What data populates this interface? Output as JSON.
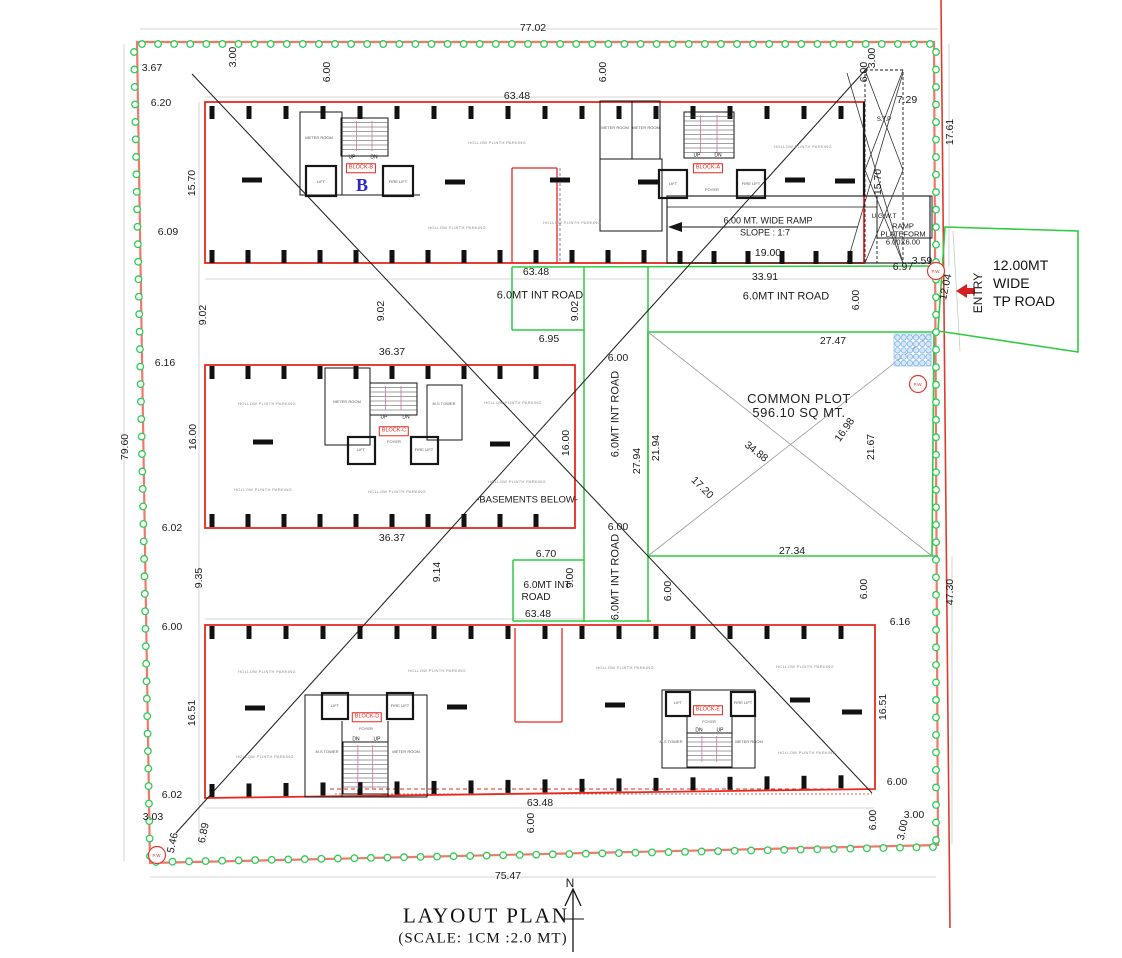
{
  "title": {
    "text": "LAYOUT PLAN",
    "scale": "(SCALE: 1CM :2.0 MT)"
  },
  "north": {
    "label": "N"
  },
  "tp_road": {
    "line1": "12.00MT",
    "line2": "WIDE",
    "line3": "TP ROAD",
    "entry": "ENTRY"
  },
  "common_plot": {
    "name": "COMMON PLOT",
    "area": "596.10 SQ MT."
  },
  "pw_marker": {
    "text": "P.W.",
    "positions": [
      [
        936,
        271
      ],
      [
        918,
        384
      ],
      [
        157,
        855
      ]
    ]
  },
  "parking": {
    "text": "HOLLOW PLINTH PARKING",
    "positions": [
      [
        497,
        143
      ],
      [
        457,
        228
      ],
      [
        572,
        223
      ],
      [
        803,
        147
      ],
      [
        267,
        404
      ],
      [
        513,
        403
      ],
      [
        263,
        490
      ],
      [
        397,
        492
      ],
      [
        517,
        482
      ],
      [
        267,
        672
      ],
      [
        437,
        671
      ],
      [
        625,
        668
      ],
      [
        805,
        667
      ],
      [
        265,
        757
      ],
      [
        807,
        753
      ]
    ]
  },
  "colors": {
    "building_red": "#e8281e",
    "boundary_red": "#f0796d",
    "road_green": "#2ecc40",
    "block_letter_blue": "#2d26c8",
    "marker_red": "#e03a2f"
  },
  "labels": [
    {
      "t": "77.02",
      "x": 533,
      "y": 28
    },
    {
      "t": "3.00",
      "x": 233,
      "y": 57,
      "r": -90
    },
    {
      "t": "3.67",
      "x": 152,
      "y": 68
    },
    {
      "t": "6.00",
      "x": 327,
      "y": 72,
      "r": -90
    },
    {
      "t": "6.00",
      "x": 603,
      "y": 72,
      "r": -90
    },
    {
      "t": "6.20",
      "x": 161,
      "y": 103
    },
    {
      "t": "63.48",
      "x": 517,
      "y": 96
    },
    {
      "t": "3.00",
      "x": 872,
      "y": 58,
      "r": -90
    },
    {
      "t": "6.00",
      "x": 864,
      "y": 72,
      "r": -90
    },
    {
      "t": "7.29",
      "x": 907,
      "y": 100
    },
    {
      "t": "17.61",
      "x": 950,
      "y": 132,
      "r": -90
    },
    {
      "t": "15.70",
      "x": 192,
      "y": 183,
      "r": -90
    },
    {
      "t": "15.70",
      "x": 878,
      "y": 182,
      "r": -90
    },
    {
      "t": "6.09",
      "x": 168,
      "y": 232
    },
    {
      "t": "63.48",
      "x": 536,
      "y": 272
    },
    {
      "t": "33.91",
      "x": 765,
      "y": 277
    },
    {
      "t": "19.00",
      "x": 768,
      "y": 253
    },
    {
      "t": "6.97",
      "x": 903,
      "y": 267
    },
    {
      "t": "3.59",
      "x": 922,
      "y": 261
    },
    {
      "t": "9.02",
      "x": 203,
      "y": 315,
      "r": -90
    },
    {
      "t": "9.02",
      "x": 381,
      "y": 311,
      "r": -90
    },
    {
      "t": "9.02",
      "x": 575,
      "y": 311,
      "r": -90
    },
    {
      "t": "6.95",
      "x": 549,
      "y": 339
    },
    {
      "t": "6.00",
      "x": 856,
      "y": 300,
      "r": -90
    },
    {
      "t": "27.47",
      "x": 833,
      "y": 341
    },
    {
      "t": "12.04",
      "x": 946,
      "y": 287,
      "r": -78
    },
    {
      "t": "79.60",
      "x": 125,
      "y": 447,
      "r": -90
    },
    {
      "t": "6.16",
      "x": 165,
      "y": 363
    },
    {
      "t": "36.37",
      "x": 392,
      "y": 352
    },
    {
      "t": "16.00",
      "x": 193,
      "y": 437,
      "r": -90
    },
    {
      "t": "6.00",
      "x": 618,
      "y": 358
    },
    {
      "t": "16.00",
      "x": 566,
      "y": 443,
      "r": -90
    },
    {
      "t": "27.94",
      "x": 637,
      "y": 461,
      "r": -90
    },
    {
      "t": "21.94",
      "x": 656,
      "y": 448,
      "r": -90
    },
    {
      "t": "17.20",
      "x": 702,
      "y": 488,
      "r": 45
    },
    {
      "t": "34.88",
      "x": 756,
      "y": 452,
      "r": 38
    },
    {
      "t": "16.98",
      "x": 845,
      "y": 430,
      "r": -55
    },
    {
      "t": "21.67",
      "x": 871,
      "y": 447,
      "r": -90
    },
    {
      "t": "6.02",
      "x": 172,
      "y": 528
    },
    {
      "t": "36.37",
      "x": 392,
      "y": 538
    },
    {
      "t": "6.00",
      "x": 618,
      "y": 527
    },
    {
      "t": "27.34",
      "x": 792,
      "y": 551
    },
    {
      "t": "9.35",
      "x": 199,
      "y": 578,
      "r": -90
    },
    {
      "t": "9.14",
      "x": 437,
      "y": 572,
      "r": -90
    },
    {
      "t": "6.70",
      "x": 546,
      "y": 554
    },
    {
      "t": "9.00",
      "x": 570,
      "y": 578,
      "r": -90
    },
    {
      "t": "63.48",
      "x": 538,
      "y": 614
    },
    {
      "t": "6.00",
      "x": 668,
      "y": 591,
      "r": -90
    },
    {
      "t": "47.30",
      "x": 950,
      "y": 592,
      "r": -90
    },
    {
      "t": "6.00",
      "x": 864,
      "y": 589,
      "r": -90
    },
    {
      "t": "6.16",
      "x": 900,
      "y": 622
    },
    {
      "t": "16.51",
      "x": 883,
      "y": 707,
      "r": -90
    },
    {
      "t": "16.51",
      "x": 192,
      "y": 713,
      "r": -90
    },
    {
      "t": "6.00",
      "x": 172,
      "y": 627
    },
    {
      "t": "6.00",
      "x": 897,
      "y": 782
    },
    {
      "t": "6.02",
      "x": 172,
      "y": 795
    },
    {
      "t": "3.03",
      "x": 153,
      "y": 817
    },
    {
      "t": "5.46",
      "x": 173,
      "y": 843,
      "r": -78
    },
    {
      "t": "6.89",
      "x": 204,
      "y": 833,
      "r": -78
    },
    {
      "t": "63.48",
      "x": 540,
      "y": 803
    },
    {
      "t": "6.00",
      "x": 531,
      "y": 823,
      "r": -90
    },
    {
      "t": "6.00",
      "x": 873,
      "y": 820,
      "r": -90
    },
    {
      "t": "3.00",
      "x": 914,
      "y": 815
    },
    {
      "t": "3.00",
      "x": 903,
      "y": 830,
      "r": -78
    },
    {
      "t": "75.47",
      "x": 508,
      "y": 876
    },
    {
      "t": "6.0MT INT ROAD",
      "x": 540,
      "y": 296,
      "s": 11,
      "n": "road-label"
    },
    {
      "t": "6.0MT INT ROAD",
      "x": 786,
      "y": 297,
      "s": 11,
      "n": "road-label"
    },
    {
      "t": "6.0MT INT ROAD",
      "x": 616,
      "y": 414,
      "r": -90,
      "s": 11,
      "n": "road-label"
    },
    {
      "t": "6.0MT INT ROAD",
      "x": 616,
      "y": 577,
      "r": -90,
      "s": 11,
      "n": "road-label"
    },
    {
      "t": "6.0MT INT",
      "x": 547,
      "y": 586,
      "s": 10,
      "n": "road-label"
    },
    {
      "t": "ROAD",
      "x": 536,
      "y": 598,
      "s": 10,
      "n": "road-label"
    },
    {
      "t": "6.00 MT. WIDE RAMP",
      "x": 768,
      "y": 221,
      "s": 9,
      "n": "ramp-note"
    },
    {
      "t": "SLOPE : 1:7",
      "x": 765,
      "y": 233,
      "s": 9,
      "n": "ramp-note"
    },
    {
      "t": "U.G.W.T",
      "x": 884,
      "y": 217,
      "s": 6.5,
      "n": "ugwt-label"
    },
    {
      "t": "RAMP",
      "x": 903,
      "y": 226,
      "s": 7.5,
      "n": "ramp-platform-label"
    },
    {
      "t": "PLATEFORM",
      "x": 903,
      "y": 234,
      "s": 7.5,
      "n": "ramp-platform-label"
    },
    {
      "t": "6.00X6.00",
      "x": 903,
      "y": 242,
      "s": 7.5,
      "n": "ramp-platform-label"
    },
    {
      "t": "S.T.P",
      "x": 884,
      "y": 120,
      "s": 6,
      "n": "stp-label"
    },
    {
      "t": "-BASEMENTS BELOW-",
      "x": 527,
      "y": 500,
      "s": 9.5,
      "n": "basements-note"
    },
    {
      "t": "BLOCK-B",
      "x": 361,
      "y": 168,
      "s": 5.5,
      "c": "redbox",
      "n": "block-b-label"
    },
    {
      "t": "B",
      "x": 362,
      "y": 185,
      "s": 18,
      "c": "blue",
      "n": "block-b-letter"
    },
    {
      "t": "BLOCK-A",
      "x": 708,
      "y": 168,
      "s": 5.5,
      "c": "redbox",
      "n": "block-a-label"
    },
    {
      "t": "BLOCK-C",
      "x": 394,
      "y": 431,
      "s": 5.5,
      "c": "redbox",
      "n": "block-c-label"
    },
    {
      "t": "BLOCK-D",
      "x": 367,
      "y": 717,
      "s": 5.5,
      "c": "redbox",
      "n": "block-d-label"
    },
    {
      "t": "BLOCK-E",
      "x": 708,
      "y": 710,
      "s": 5.5,
      "c": "redbox",
      "n": "block-e-label"
    },
    {
      "t": "UP",
      "x": 352,
      "y": 158,
      "s": 5,
      "n": "stair-direction-label"
    },
    {
      "t": "DN",
      "x": 374,
      "y": 158,
      "s": 5,
      "n": "stair-direction-label"
    },
    {
      "t": "UP",
      "x": 697,
      "y": 156,
      "s": 5,
      "n": "stair-direction-label"
    },
    {
      "t": "DN",
      "x": 718,
      "y": 156,
      "s": 5,
      "n": "stair-direction-label"
    },
    {
      "t": "UP",
      "x": 384,
      "y": 418,
      "s": 5,
      "n": "stair-direction-label"
    },
    {
      "t": "DN",
      "x": 406,
      "y": 418,
      "s": 5,
      "n": "stair-direction-label"
    },
    {
      "t": "DN",
      "x": 356,
      "y": 740,
      "s": 5,
      "n": "stair-direction-label"
    },
    {
      "t": "UP",
      "x": 377,
      "y": 740,
      "s": 5,
      "n": "stair-direction-label"
    },
    {
      "t": "DN",
      "x": 699,
      "y": 731,
      "s": 5,
      "n": "stair-direction-label"
    },
    {
      "t": "UP",
      "x": 720,
      "y": 731,
      "s": 5,
      "n": "stair-direction-label"
    },
    {
      "t": "METER ROOM",
      "x": 319,
      "y": 138,
      "s": 4,
      "c": "room",
      "n": "room-label"
    },
    {
      "t": "LIFT",
      "x": 321,
      "y": 182,
      "s": 4,
      "c": "room",
      "n": "room-label"
    },
    {
      "t": "FIRE LIFT",
      "x": 398,
      "y": 182,
      "s": 4,
      "c": "room",
      "n": "room-label"
    },
    {
      "t": "METER ROOM",
      "x": 615,
      "y": 128,
      "s": 4,
      "c": "room",
      "n": "room-label"
    },
    {
      "t": "METER ROOM",
      "x": 646,
      "y": 128,
      "s": 4,
      "c": "room",
      "n": "room-label"
    },
    {
      "t": "LIFT",
      "x": 673,
      "y": 184,
      "s": 4,
      "c": "room",
      "n": "room-label"
    },
    {
      "t": "FIRE LIFT",
      "x": 751,
      "y": 184,
      "s": 4,
      "c": "room",
      "n": "room-label"
    },
    {
      "t": "FOYER",
      "x": 712,
      "y": 190,
      "s": 4,
      "c": "room",
      "n": "room-label"
    },
    {
      "t": "METER ROOM",
      "x": 347,
      "y": 402,
      "s": 4,
      "c": "room",
      "n": "room-label"
    },
    {
      "t": "M.S TOWER",
      "x": 444,
      "y": 404,
      "s": 4,
      "c": "room",
      "n": "room-label"
    },
    {
      "t": "LIFT",
      "x": 361,
      "y": 450,
      "s": 4,
      "c": "room",
      "n": "room-label"
    },
    {
      "t": "FIRE LIFT",
      "x": 424,
      "y": 450,
      "s": 4,
      "c": "room",
      "n": "room-label"
    },
    {
      "t": "FOYER",
      "x": 394,
      "y": 442,
      "s": 4,
      "c": "room",
      "n": "room-label"
    },
    {
      "t": "M.S TOWER",
      "x": 327,
      "y": 752,
      "s": 4,
      "c": "room",
      "n": "room-label"
    },
    {
      "t": "METER ROOM",
      "x": 406,
      "y": 752,
      "s": 4,
      "c": "room",
      "n": "room-label"
    },
    {
      "t": "LIFT",
      "x": 335,
      "y": 706,
      "s": 4,
      "c": "room",
      "n": "room-label"
    },
    {
      "t": "FIRE LIFT",
      "x": 400,
      "y": 706,
      "s": 4,
      "c": "room",
      "n": "room-label"
    },
    {
      "t": "FOYER",
      "x": 366,
      "y": 729,
      "s": 4,
      "c": "room",
      "n": "room-label"
    },
    {
      "t": "M.S TOWER",
      "x": 671,
      "y": 742,
      "s": 4,
      "c": "room",
      "n": "room-label"
    },
    {
      "t": "METER ROOM",
      "x": 749,
      "y": 742,
      "s": 4,
      "c": "room",
      "n": "room-label"
    },
    {
      "t": "LIFT",
      "x": 678,
      "y": 703,
      "s": 4,
      "c": "room",
      "n": "room-label"
    },
    {
      "t": "FIRE LIFT",
      "x": 743,
      "y": 703,
      "s": 4,
      "c": "room",
      "n": "room-label"
    },
    {
      "t": "FOYER",
      "x": 709,
      "y": 722,
      "s": 4,
      "c": "room",
      "n": "room-label"
    }
  ]
}
